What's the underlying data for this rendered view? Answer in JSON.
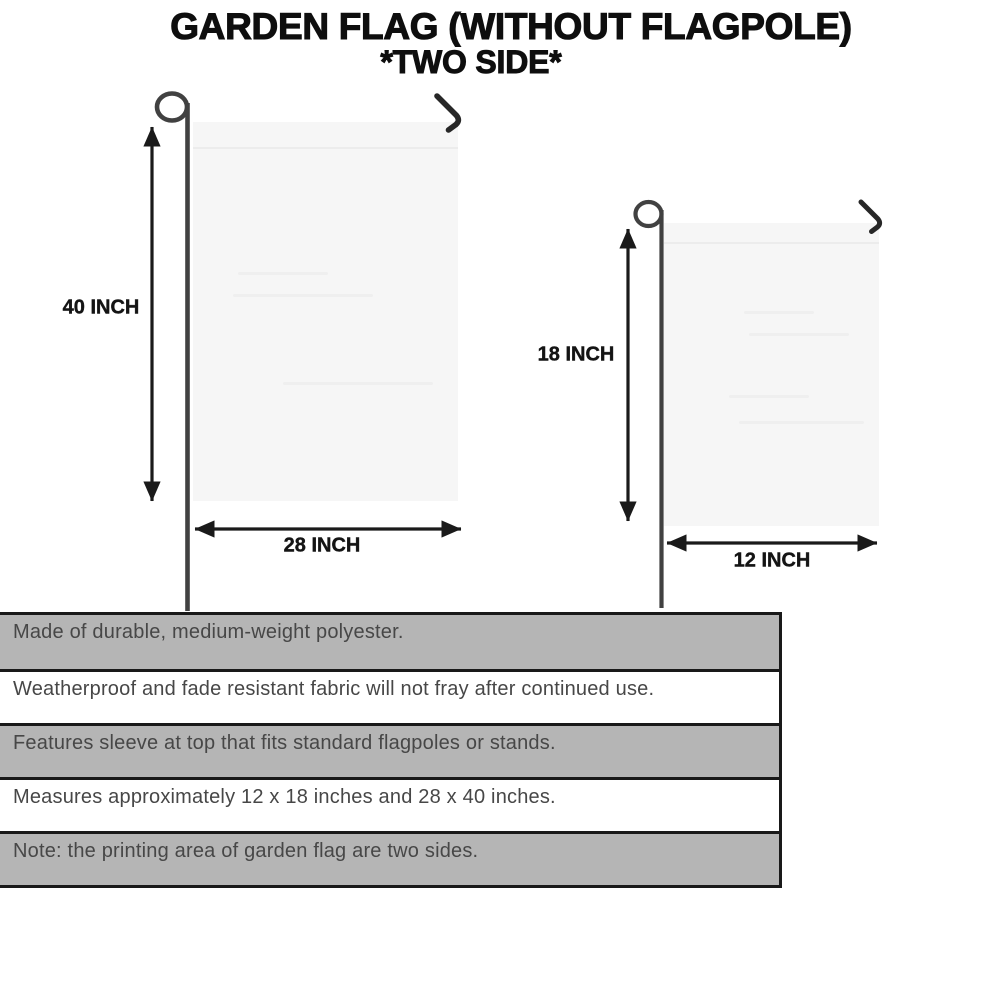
{
  "title": {
    "line1": "GARDEN FLAG (WITHOUT FLAGPOLE)",
    "line2": "*TWO SIDE*"
  },
  "flags": {
    "large": {
      "height_label": "40 INCH",
      "width_label": "28 INCH"
    },
    "small": {
      "height_label": "18 INCH",
      "width_label": "12 INCH"
    }
  },
  "specs": {
    "rows": [
      "Made of durable, medium-weight polyester.",
      "Weatherproof and fade resistant fabric will not fray after continued use.",
      "Features sleeve at top that fits standard flagpoles or stands.",
      "Measures approximately 12 x 18 inches and 28 x 40 inches.",
      "Note: the printing area of garden flag are two sides."
    ]
  },
  "colors": {
    "row_gray": "#b5b5b5",
    "table_border": "#191919",
    "flag_fill": "#f6f6f6",
    "pole": "#414141",
    "arrow": "#1a1a1a",
    "title_text": "#0e0e0e",
    "spec_text": "#474747"
  }
}
